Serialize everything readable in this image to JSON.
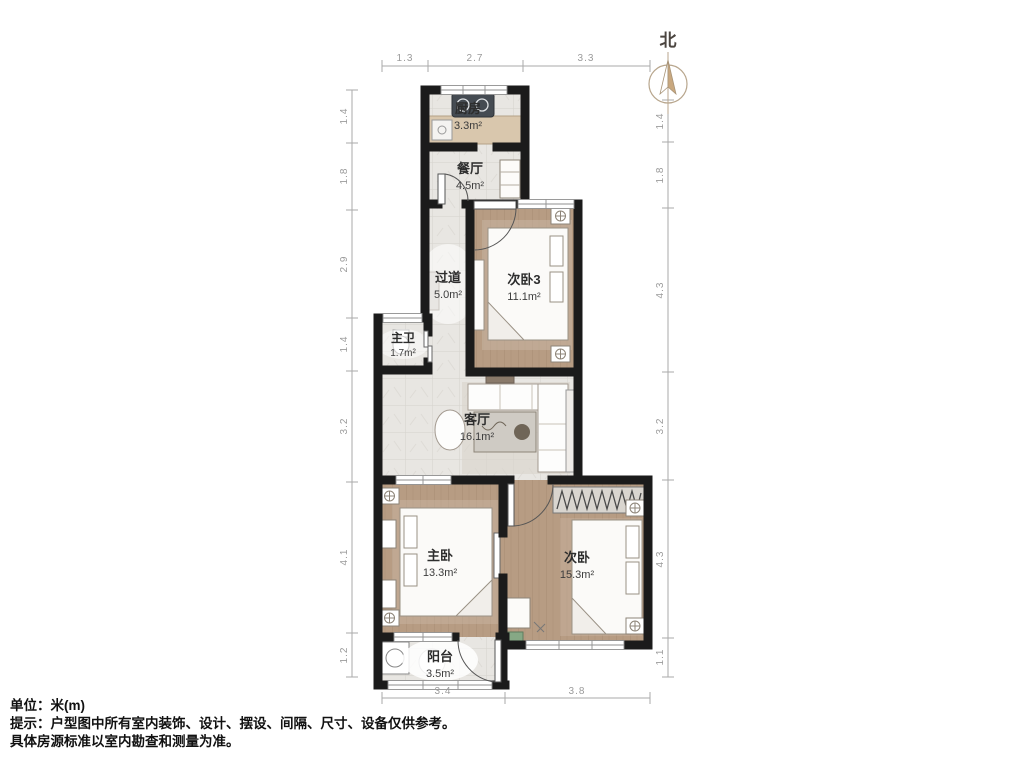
{
  "compass": {
    "label": "北"
  },
  "rooms": {
    "kitchen": {
      "name": "厨房",
      "area": "3.3m²"
    },
    "dining": {
      "name": "餐厅",
      "area": "4.5m²"
    },
    "hallway": {
      "name": "过道",
      "area": "5.0m²"
    },
    "bedroom3": {
      "name": "次卧3",
      "area": "11.1m²"
    },
    "masterbath": {
      "name": "主卫",
      "area": "1.7m²"
    },
    "living": {
      "name": "客厅",
      "area": "16.1m²"
    },
    "master": {
      "name": "主卧",
      "area": "13.3m²"
    },
    "bedroom2": {
      "name": "次卧",
      "area": "15.3m²"
    },
    "balcony": {
      "name": "阳台",
      "area": "3.5m²"
    }
  },
  "dimensions": {
    "top": [
      "1.3",
      "2.7",
      "3.3"
    ],
    "left": [
      "1.4",
      "1.8",
      "2.9",
      "1.4",
      "3.2",
      "4.1",
      "1.2"
    ],
    "right": [
      "1.4",
      "1.8",
      "4.3",
      "3.2",
      "4.3",
      "1.1"
    ],
    "bottom": [
      "3.4",
      "3.8"
    ]
  },
  "footer": {
    "line1": "单位：米(m)",
    "line2": "提示：户型图中所有室内装饰、设计、摆设、间隔、尺寸、设备仅供参考。",
    "line3": "具体房源标准以室内勘查和测量为准。"
  },
  "colors": {
    "wall": "#1b1b1b",
    "wood_floor": "#b79c83",
    "tile_floor": "#e8e6e2",
    "compass_accent": "#c9a87f",
    "dimension_text": "#9b9b9b"
  }
}
